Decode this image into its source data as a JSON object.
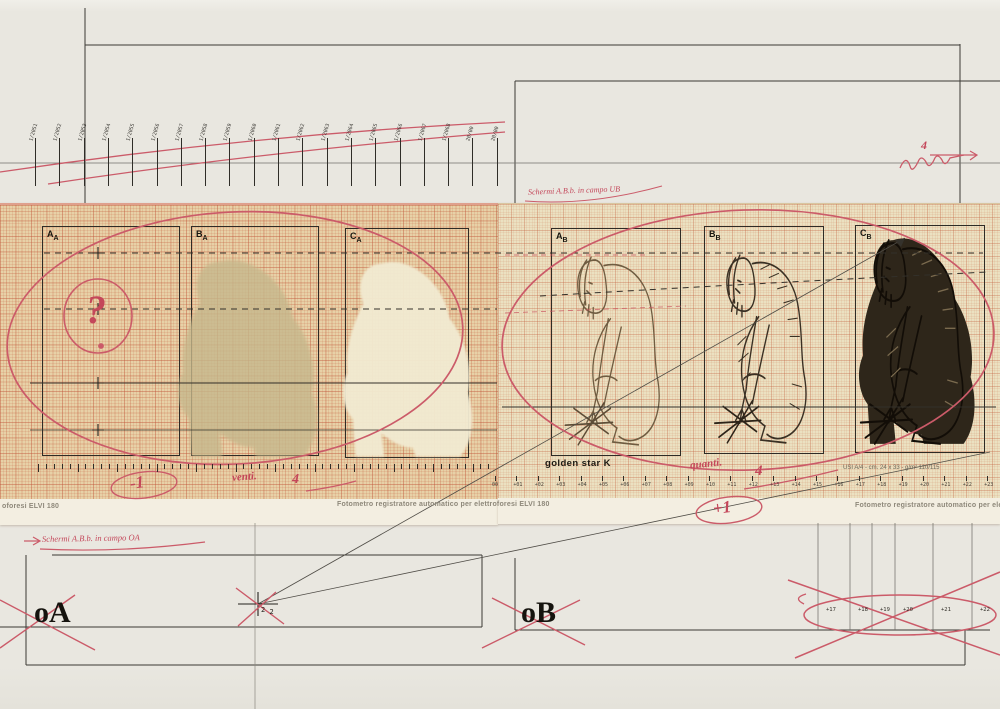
{
  "colors": {
    "red_ink": "#c4475a",
    "paper_left": "#e7d1a7",
    "paper_right": "#ebe1c1",
    "ink_black": "#2e2b26",
    "figure_sepia": "#6f5c41",
    "figure_dark": "#2e261a"
  },
  "top_scale": {
    "labels": [
      "1/2051",
      "1/2052",
      "1/2053",
      "1/2054",
      "1/2055",
      "1/2056",
      "1/2057",
      "1/2058",
      "1/2059",
      "1/2060",
      "1/2061",
      "1/2062",
      "1/2063",
      "1/2064",
      "1/2065",
      "1/2066",
      "1/2067",
      "1/2068",
      "20/00",
      "20/00"
    ]
  },
  "notes": {
    "mid_note": "Schermi A.B.b. in campo UB",
    "bottom_note": "Schermi A.B.b. in campo OA",
    "scribble_four": "4"
  },
  "sheets": {
    "left": {
      "footer_cut": "oforesi ELVI 180",
      "footer_center": "Fotometro registratore automatico per elettroforesi ELVI 180",
      "minus_one": "-1",
      "venti": "venti.",
      "four": "4",
      "question_mark": "?",
      "panels": [
        {
          "m": "A",
          "s": "A"
        },
        {
          "m": "B",
          "s": "A"
        },
        {
          "m": "C",
          "s": "A"
        }
      ]
    },
    "right": {
      "brand": "golden star K",
      "paper_spec": "USI A/4 - cm. 24 x 33 - g/m² 110/115",
      "footer_cut": "Fotometro registratore automatico per ele",
      "plus_one": "+1",
      "quanti": "quanti.",
      "four": "4",
      "scale_labels": [
        "00",
        "+01",
        "+02",
        "+03",
        "+04",
        "+05",
        "+06",
        "+07",
        "+08",
        "+09",
        "+10",
        "+11",
        "+12",
        "+13",
        "+14",
        "+15",
        "+16",
        "+17",
        "+18",
        "+19",
        "+20",
        "+21",
        "+22",
        "+23"
      ],
      "panels": [
        {
          "m": "A",
          "s": "B"
        },
        {
          "m": "B",
          "s": "B"
        },
        {
          "m": "C",
          "s": "B"
        }
      ]
    }
  },
  "bottom": {
    "oa": "oA",
    "ob": "oB",
    "cross_sub_1": "2",
    "cross_sub_2": "2",
    "scale_labels": [
      "+17",
      "+18",
      "+19",
      "+20",
      "+21",
      "+22"
    ]
  }
}
